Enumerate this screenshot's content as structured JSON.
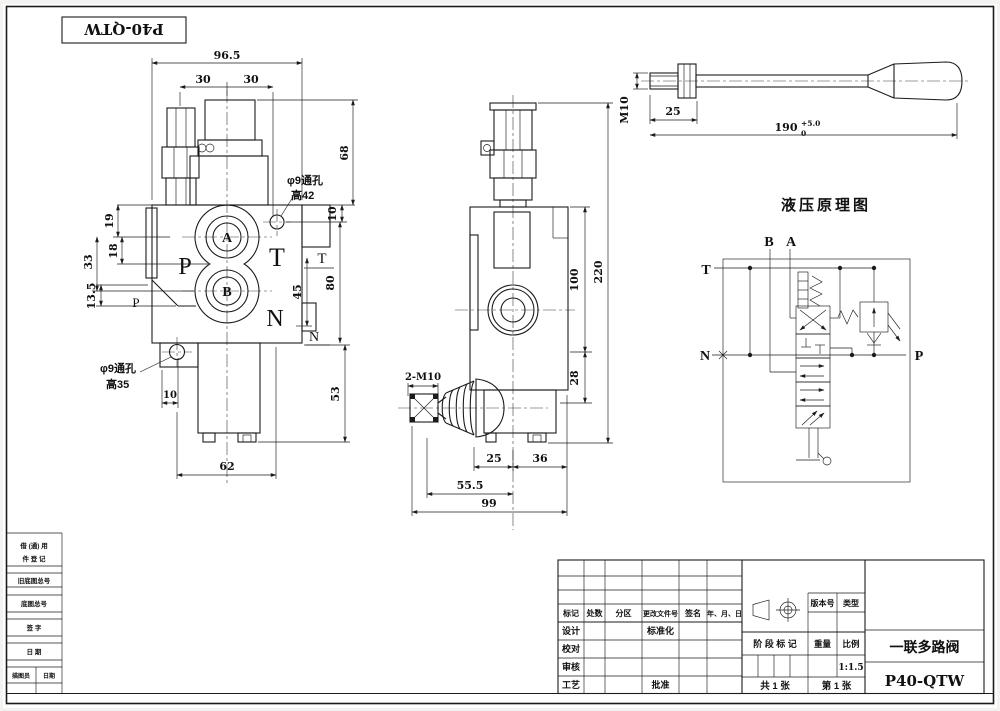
{
  "colors": {
    "ink": "#1b1b1b",
    "paper": "#ffffff"
  },
  "code_box": {
    "text": "P40-QTW"
  },
  "front_view": {
    "dims": {
      "d96_5": "96.5",
      "d30a": "30",
      "d30b": "30",
      "d68": "68",
      "d10r": "10",
      "d19": "19",
      "d18": "18",
      "d33": "33",
      "d13_5": "13.5",
      "d80": "80",
      "d45": "45",
      "d53": "53",
      "d10b": "10",
      "d62": "62"
    },
    "ports": {
      "a": "A",
      "b": "B"
    },
    "labels": {
      "p_large": "P",
      "t_large": "T",
      "n_large": "N",
      "p_small": "P",
      "t_small": "T",
      "n_small": "N"
    },
    "notes": {
      "top1": "φ9通孔",
      "top2": "高42",
      "bottom1": "φ9通孔",
      "bottom2": "高35"
    }
  },
  "side_view": {
    "dims": {
      "d220": "220",
      "d100": "100",
      "d28": "28",
      "d25": "25",
      "d36": "36",
      "d55_5": "55.5",
      "d99": "99"
    },
    "labels": {
      "stud": "2-M10"
    }
  },
  "handle_view": {
    "dims": {
      "m10": "M10",
      "d25": "25",
      "d190": "190",
      "tol_upper": "+5.0",
      "tol_lower": "0"
    }
  },
  "schematic": {
    "title": "液压原理图",
    "ports": {
      "t": "T",
      "b": "B",
      "a": "A",
      "n": "N",
      "p": "P"
    }
  },
  "title_block": {
    "headers": {
      "mark": "标记",
      "count": "处数",
      "zone": "分区",
      "doc_no": "更改文件号",
      "sign": "签名",
      "date": "年、月、日"
    },
    "rows": {
      "design": "设计",
      "proof": "校对",
      "audit": "审核",
      "process": "工艺",
      "standard": "标准化",
      "approve": "批准"
    },
    "info": {
      "version": "版本号",
      "type": "类型",
      "stage": "阶 段 标 记",
      "weight": "重量",
      "scale": "比例",
      "scale_value": "1:1.5",
      "sheets_total": "共 1 张",
      "sheet_no": "第 1 张"
    },
    "product": {
      "name": "一联多路阀",
      "model": "P40-QTW"
    }
  },
  "side_blocks": {
    "row1_line1": "借 (通) 用",
    "row1_line2": "件 登 记",
    "row2": "旧底图总号",
    "row3": "底图总号",
    "row4": "签  字",
    "row5": "日  期",
    "row6_left": "描图员",
    "row6_right": "日期"
  }
}
